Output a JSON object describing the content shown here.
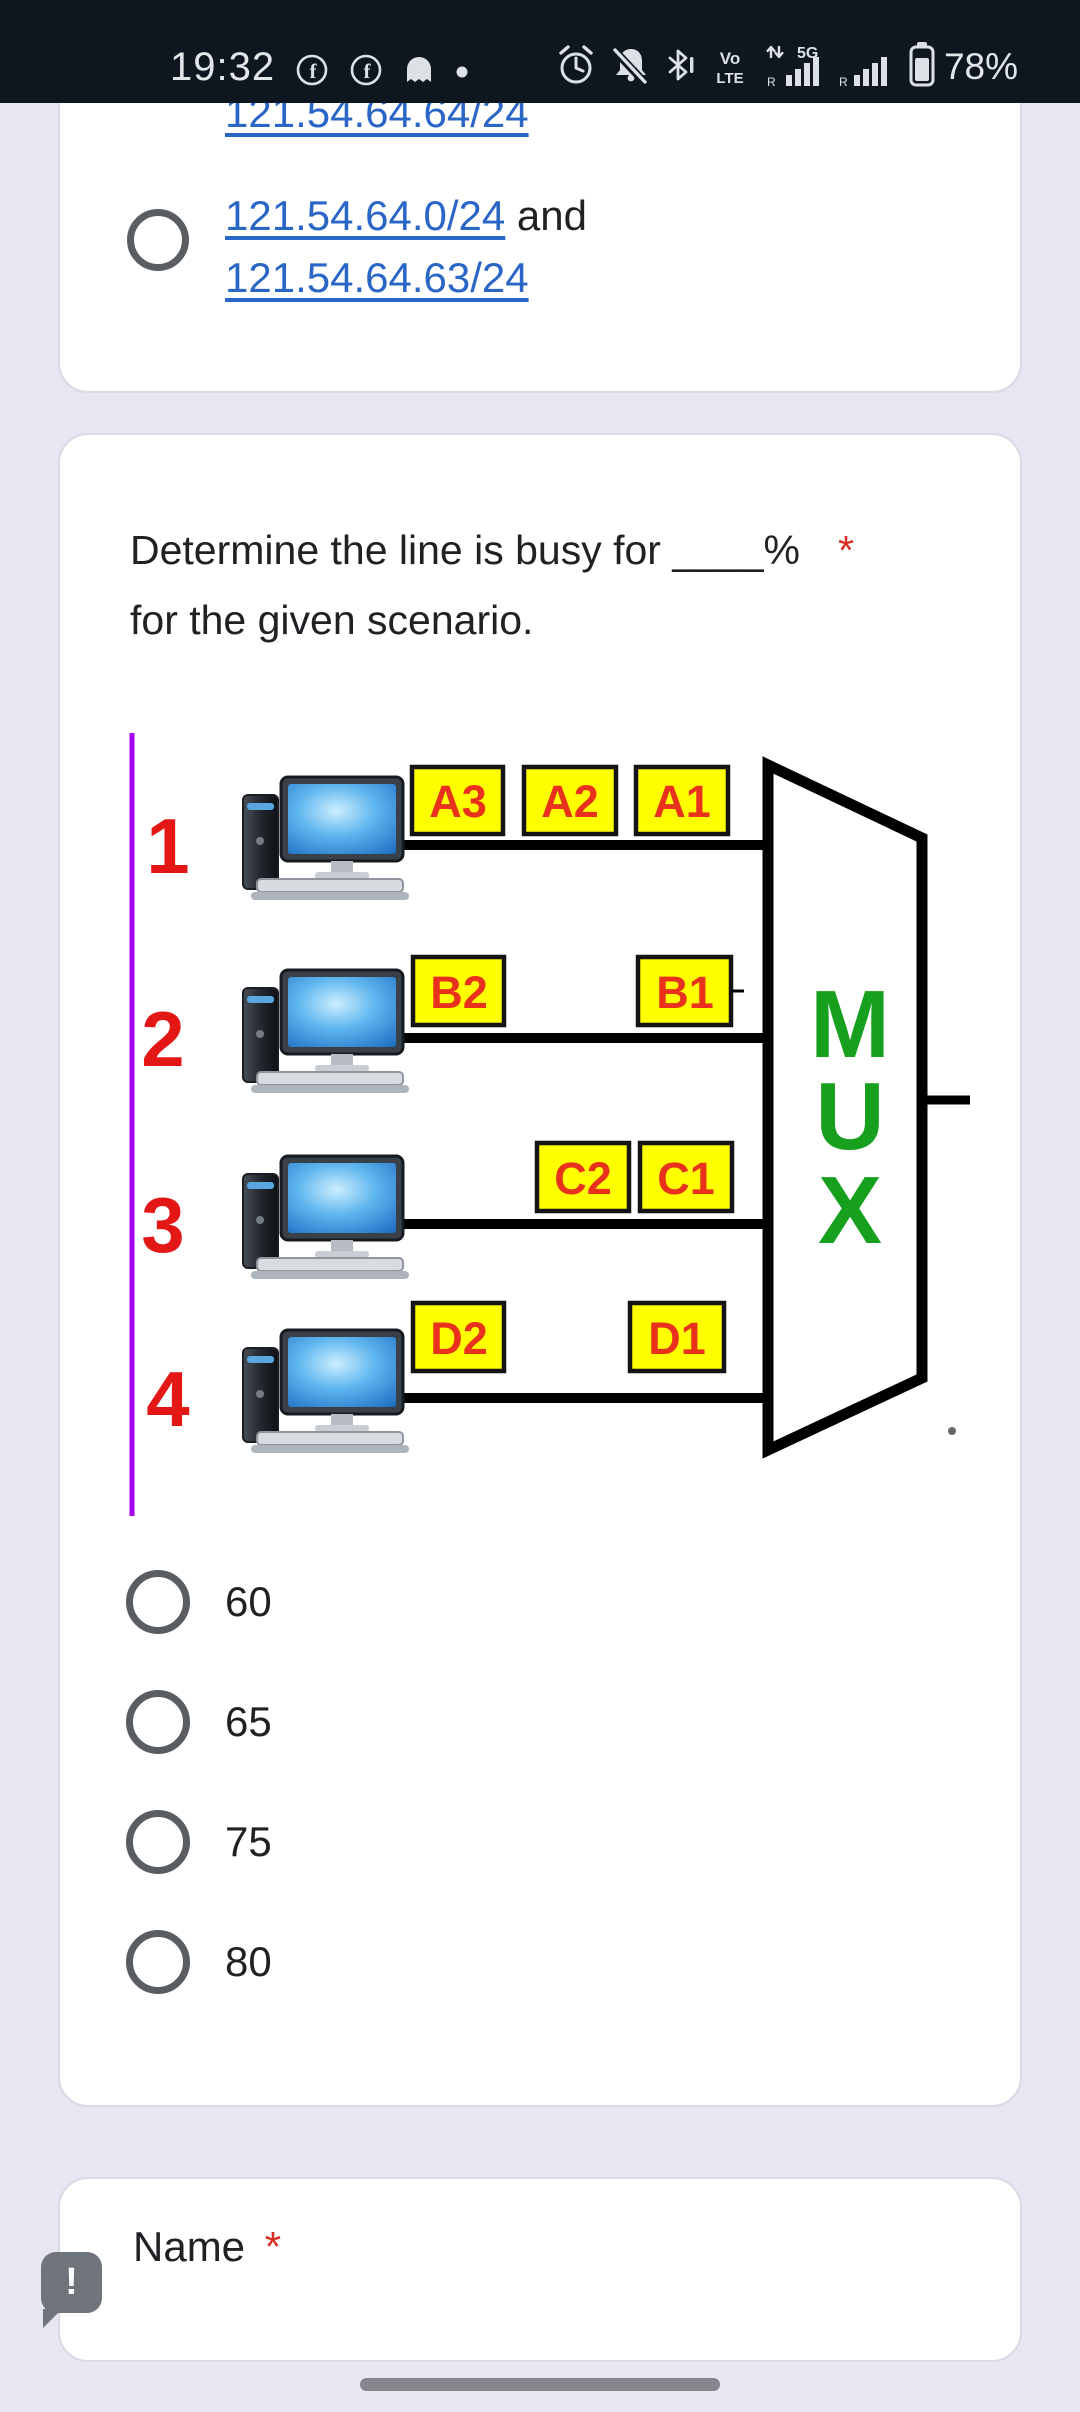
{
  "colors": {
    "link": "#2a66c6",
    "required": "#d93025",
    "packet-fill": "#ffff00",
    "packet-text": "#e8321d",
    "mux-green": "#17a01d",
    "line-purple": "#a404f2",
    "number-red": "#e41717"
  },
  "status_bar": {
    "time": "19:32",
    "battery_percent": "78%",
    "volte_top": "Vo",
    "volte_bottom": "LTE",
    "net1_label": "5G",
    "net1_roaming": "R",
    "net2_roaming": "R",
    "icons": [
      "facebook-icon",
      "facebook-icon",
      "snapchat-icon",
      "notification-dot-icon",
      "alarm-icon",
      "bell-off-icon",
      "bluetooth-icon",
      "volte-icon",
      "signal-5g-icon",
      "signal-icon",
      "battery-icon"
    ]
  },
  "card_previous": {
    "clipped_link": "121.54.64.64/24",
    "option": {
      "link1": "121.54.64.0/24",
      "conjunction": " and",
      "link2": "121.54.64.63/24"
    }
  },
  "question_card": {
    "title_line1": "Determine the line is busy for ____%",
    "required_mark": "*",
    "title_line2": "for the given scenario.",
    "options": [
      {
        "label": "60"
      },
      {
        "label": "65"
      },
      {
        "label": "75"
      },
      {
        "label": "80"
      }
    ]
  },
  "diagram": {
    "line_numbers": [
      "1",
      "2",
      "3",
      "4"
    ],
    "packets": {
      "row1": [
        "A3",
        "A2",
        "A1"
      ],
      "row2": [
        "B2",
        "B1"
      ],
      "row3": [
        "C2",
        "C1"
      ],
      "row4": [
        "D2",
        "D1"
      ]
    },
    "mux_letters": [
      "M",
      "U",
      "X"
    ]
  },
  "name_card": {
    "label": "Name",
    "required_mark": "*"
  },
  "floating_button": {
    "label": "!"
  }
}
